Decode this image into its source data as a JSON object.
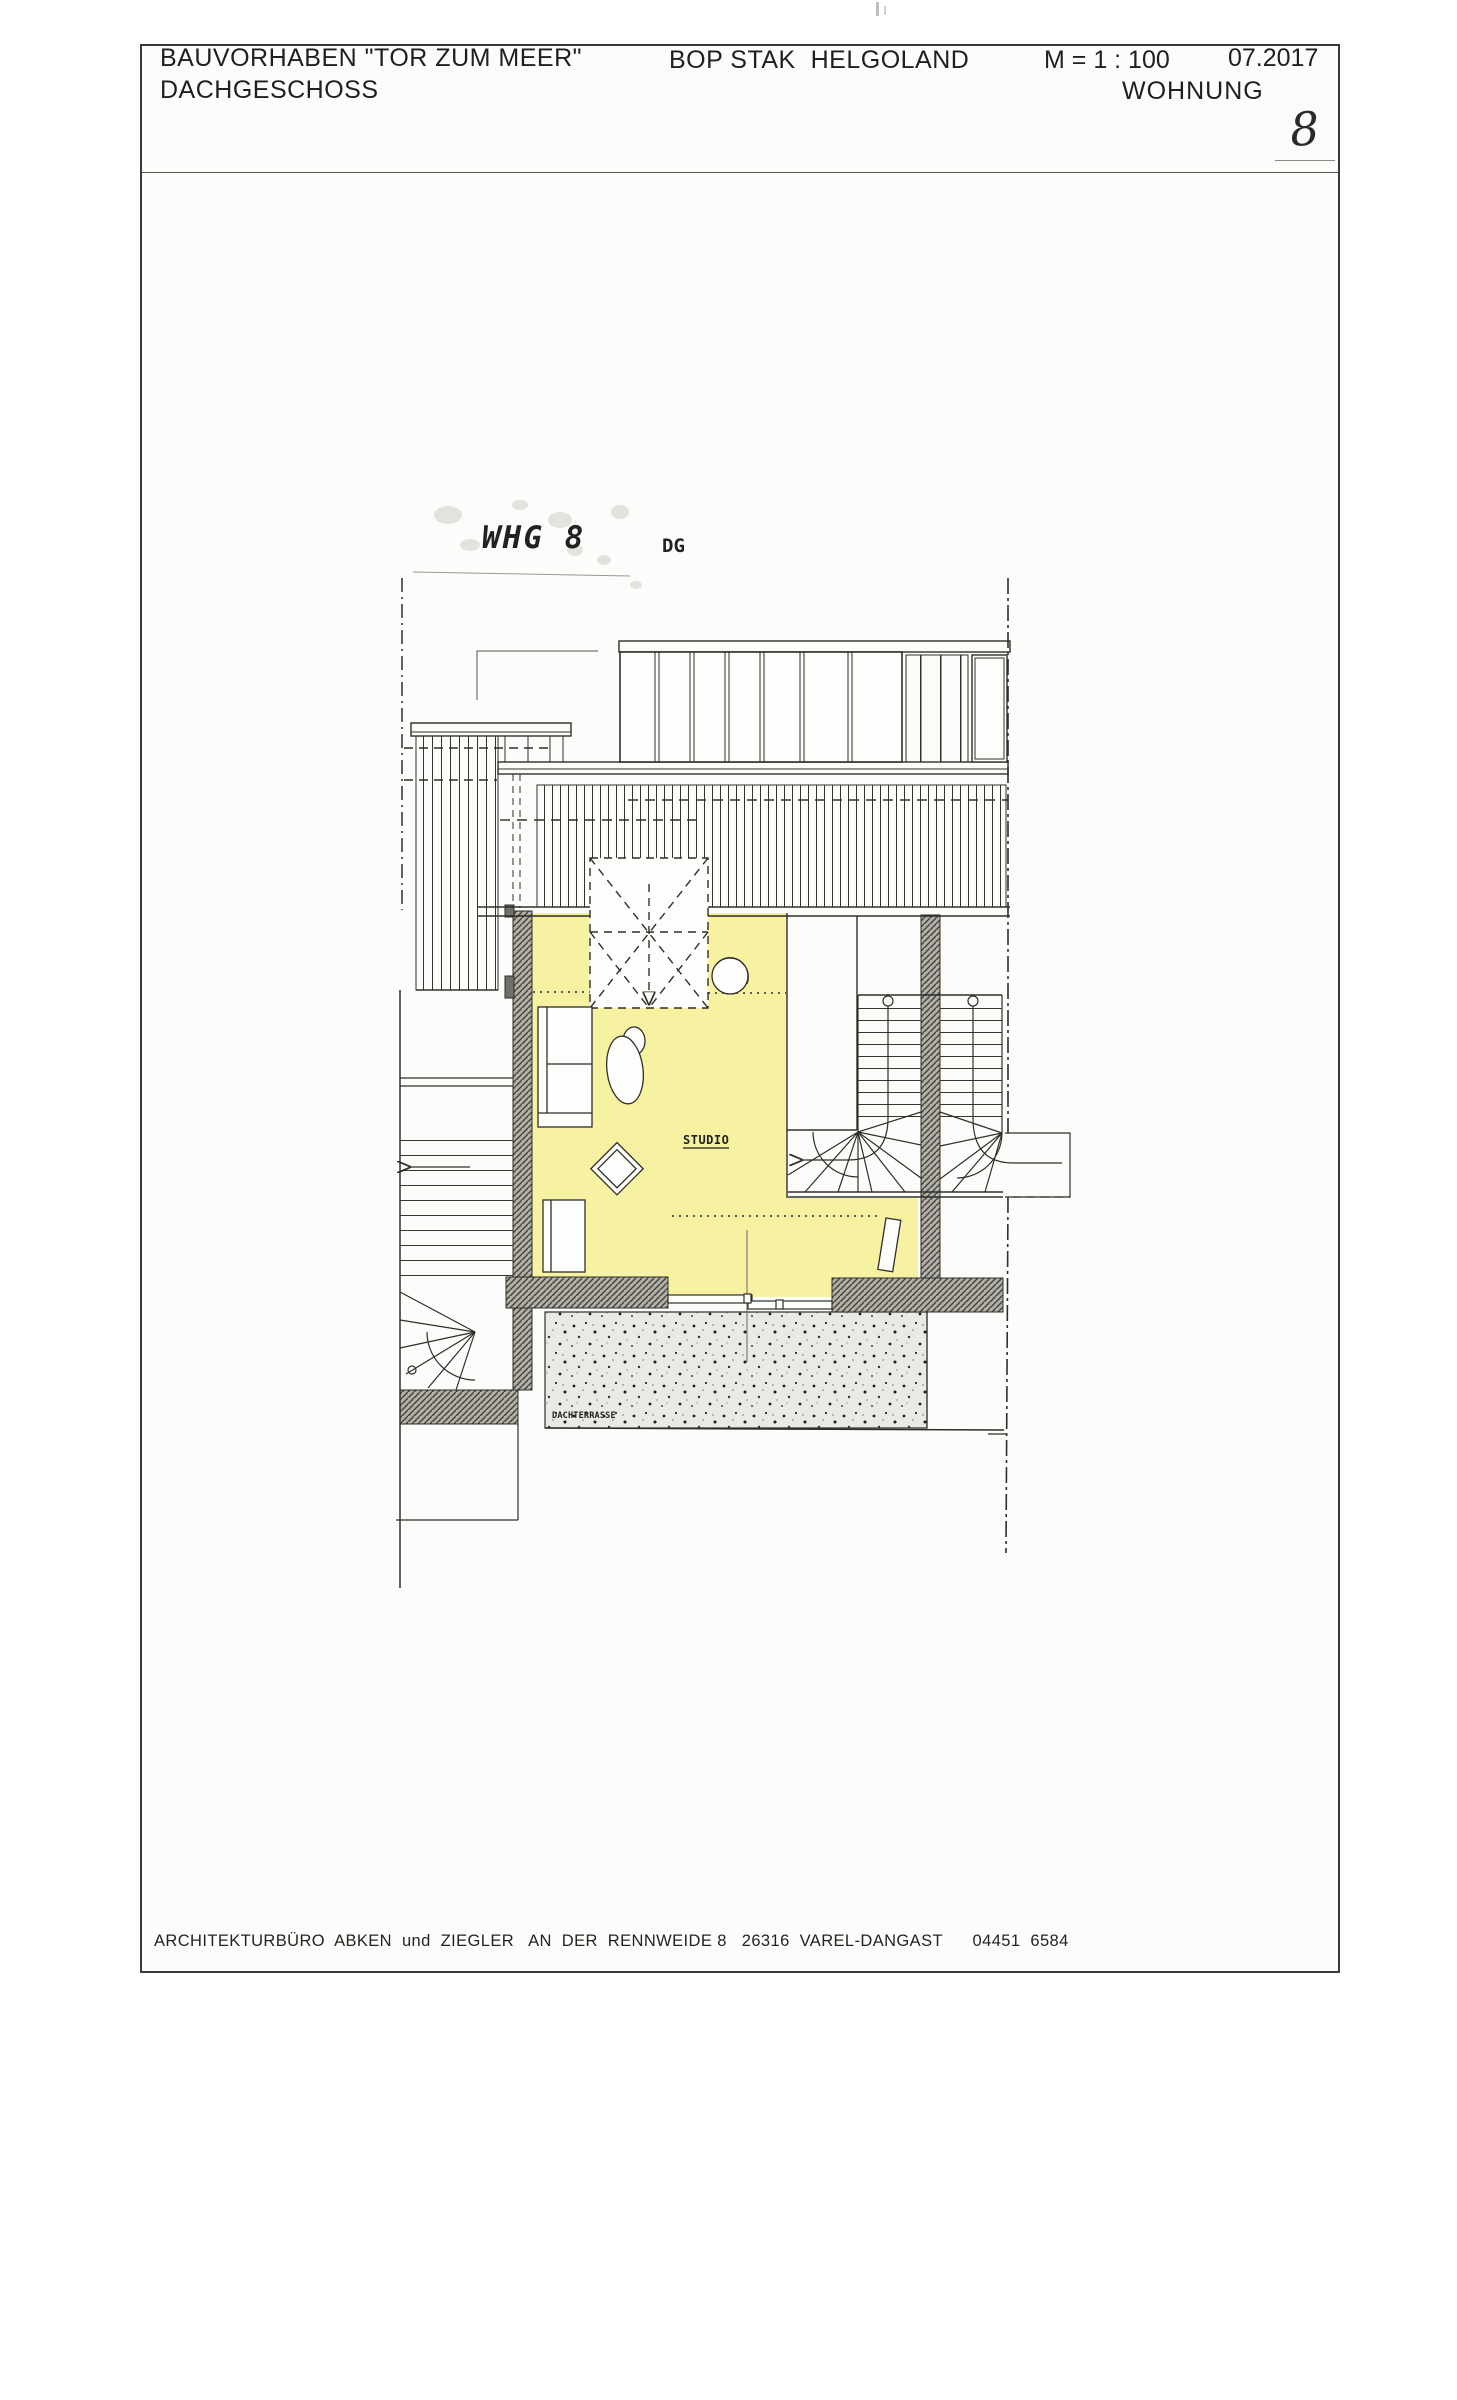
{
  "header": {
    "project": "BAUVORHABEN \"TOR ZUM MEER\"",
    "floor": "DACHGESCHOSS",
    "client": "BOP STAK  HELGOLAND",
    "scale": "M = 1 : 100",
    "date": "07.2017",
    "unit_label": "WOHNUNG",
    "unit_number": "8"
  },
  "plan": {
    "apartment_label": "WHG 8",
    "floor_code": "DG",
    "room_label": "STUDIO",
    "terrace_label": "DACHTERRASSE"
  },
  "footer": {
    "text": "ARCHITEKTURBÜRO  ABKEN  und  ZIEGLER   AN  DER  RENNWEIDE 8   26316  VAREL-DANGAST      04451  6584"
  },
  "colors": {
    "room_fill": "#f7f1a2",
    "terrace_fill": "#eae9e3",
    "wall_fill": "#b3b0a8",
    "line": "#2e2e2a"
  }
}
